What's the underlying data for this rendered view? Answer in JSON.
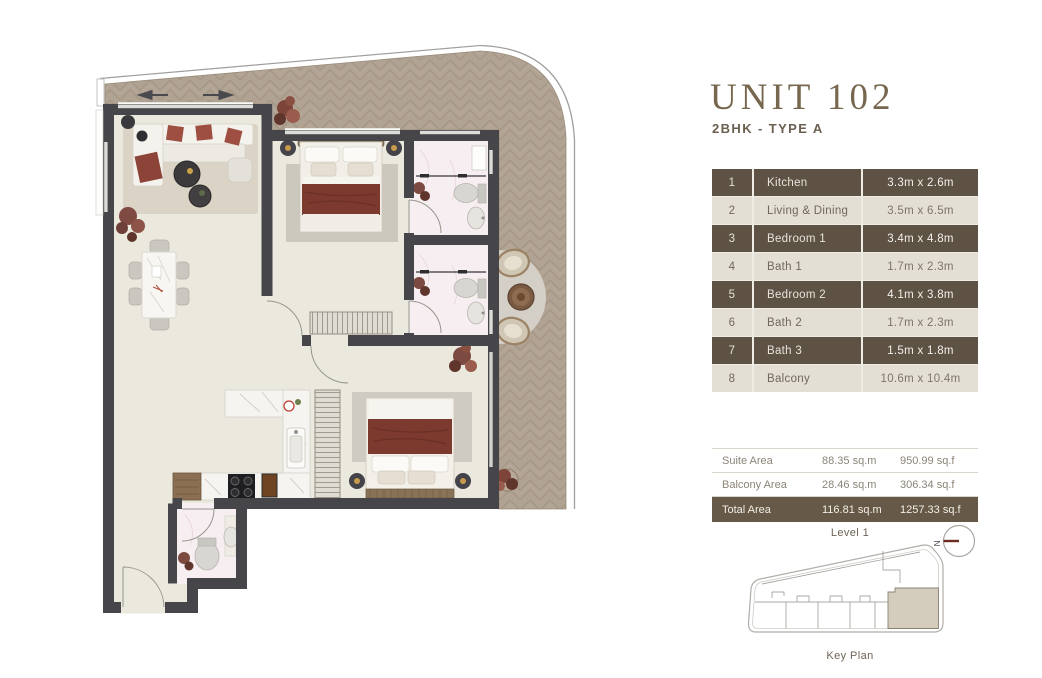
{
  "header": {
    "title": "UNIT 102",
    "subtitle": "2BHK - TYPE A"
  },
  "rooms_table": {
    "rows": [
      {
        "no": "1",
        "name": "Kitchen",
        "dims": "3.3m x 2.6m"
      },
      {
        "no": "2",
        "name": "Living & Dining",
        "dims": "3.5m x 6.5m"
      },
      {
        "no": "3",
        "name": "Bedroom 1",
        "dims": "3.4m x 4.8m"
      },
      {
        "no": "4",
        "name": "Bath 1",
        "dims": "1.7m x 2.3m"
      },
      {
        "no": "5",
        "name": "Bedroom 2",
        "dims": "4.1m x 3.8m"
      },
      {
        "no": "6",
        "name": "Bath 2",
        "dims": "1.7m x 2.3m"
      },
      {
        "no": "7",
        "name": "Bath 3",
        "dims": "1.5m x 1.8m"
      },
      {
        "no": "8",
        "name": "Balcony",
        "dims": "10.6m x 10.4m"
      }
    ]
  },
  "areas_table": {
    "rows": [
      {
        "label": "Suite Area",
        "sqm": "88.35 sq.m",
        "sqf": "950.99 sq.f"
      },
      {
        "label": "Balcony Area",
        "sqm": "28.46 sq.m",
        "sqf": "306.34 sq.f"
      },
      {
        "label": "Total Area",
        "sqm": "116.81 sq.m",
        "sqf": "1257.33 sq.f"
      }
    ]
  },
  "key_plan": {
    "level_label": "Level 1",
    "caption": "Key Plan",
    "compass_letter": "N"
  },
  "colors": {
    "accent_dark_brown": "#5e5245",
    "total_row_brown": "#675947",
    "row_light_beige": "#e4dfd4",
    "title_brown": "#77674f",
    "deck_wood": "#b1a393",
    "wall_gray": "#46464a",
    "floor_cream": "#ebe8dd",
    "blanket_red": "#7c3a2e",
    "keyplan_highlight": "#d4cdbe",
    "compass_needle": "#6e2c21"
  }
}
